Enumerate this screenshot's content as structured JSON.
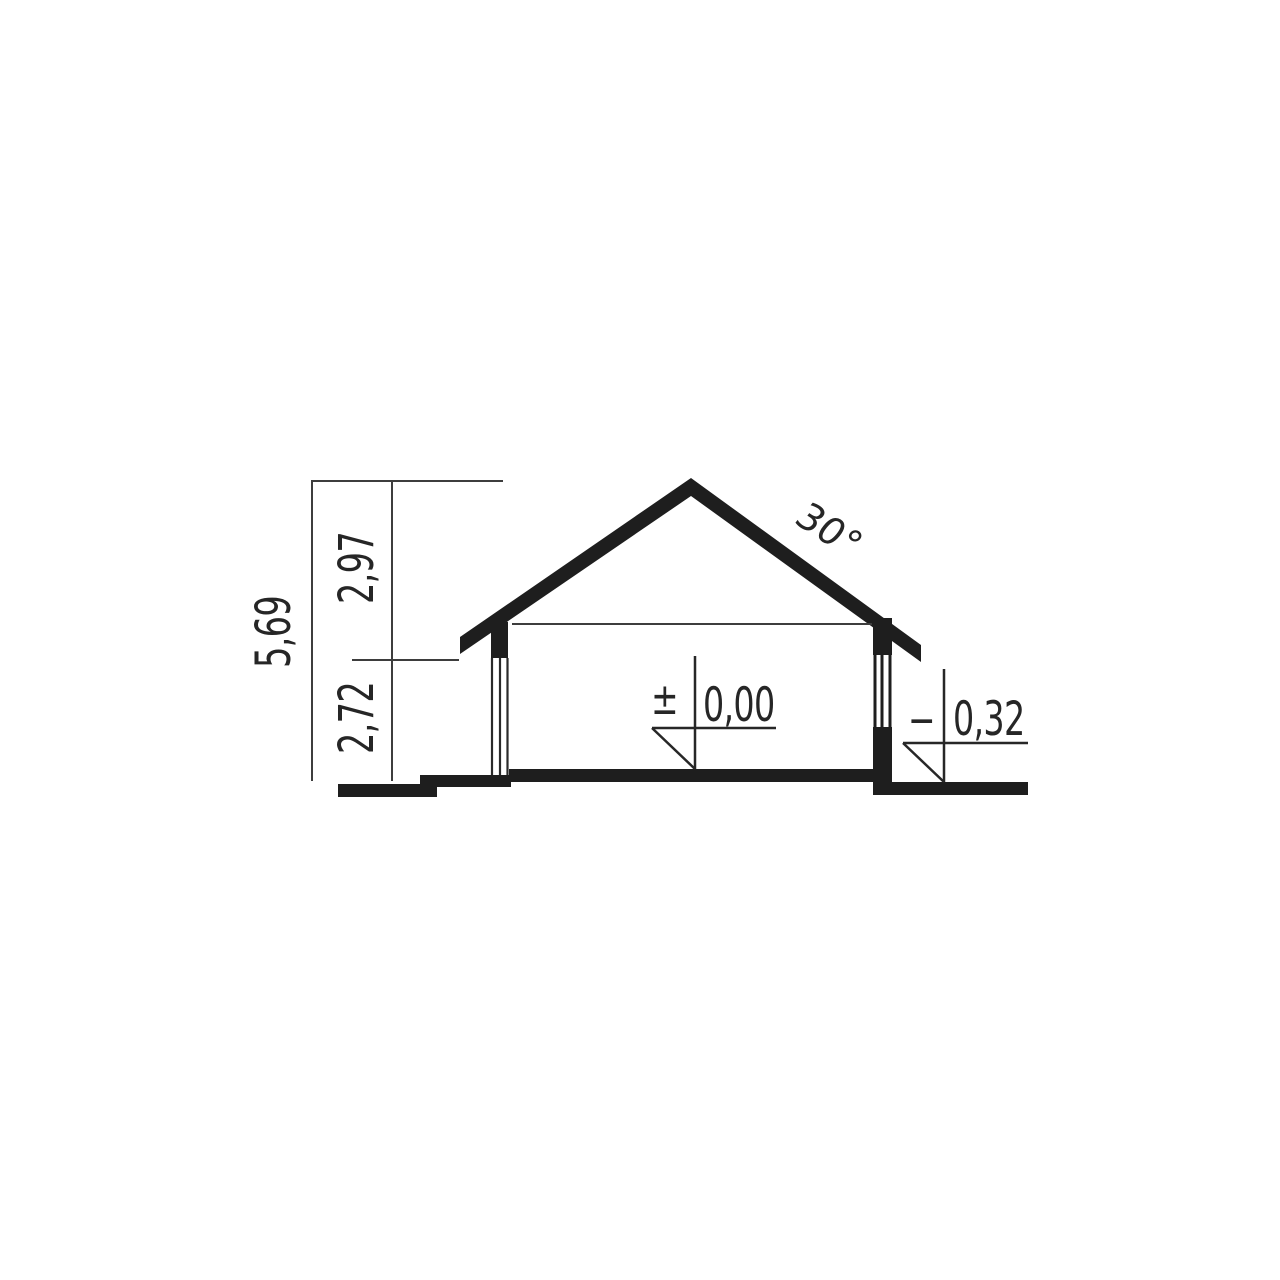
{
  "dimensions": {
    "total": "5,69",
    "upper": "2,97",
    "lower": "2,72"
  },
  "roof": {
    "angle": "30°"
  },
  "levels": {
    "floor_sign": "±",
    "floor_value": "0,00",
    "ground_sign": "−",
    "ground_value": "0,32"
  },
  "colors": {
    "ink": "#1e1e1e",
    "thin_line": "#3d3d3d",
    "background": "#ffffff"
  }
}
